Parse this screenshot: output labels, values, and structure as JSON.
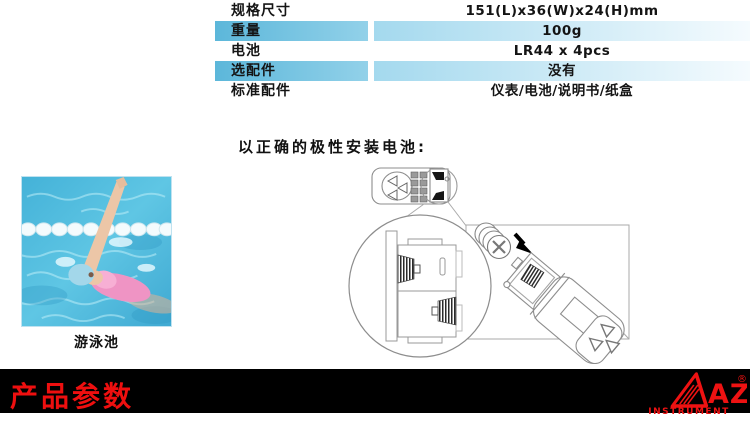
{
  "spec_table": {
    "rows": [
      {
        "label": "规格尺寸",
        "value": "151(L)x36(W)x24(H)mm"
      },
      {
        "label": "重量",
        "value": "100g"
      },
      {
        "label": "电池",
        "value": "LR44 x 4pcs"
      },
      {
        "label": "选配件",
        "value": "没有"
      },
      {
        "label": "标准配件",
        "value": "仪表/电池/说明书/纸盒"
      }
    ]
  },
  "instruction": {
    "text": "以正确的极性安装电池:"
  },
  "pool": {
    "caption": "游泳池"
  },
  "footer": {
    "title": "产品参数",
    "logo_text": "AZ",
    "registered_mark": "®",
    "logo_subtext": "INSTRUMENT"
  },
  "colors": {
    "table_label_blue": "#5cb7da",
    "table_value_blue": "#a4d9ee",
    "footer_background": "#000000",
    "footer_red": "#ee0f0f",
    "pool_water_blue": "#53bddd"
  }
}
